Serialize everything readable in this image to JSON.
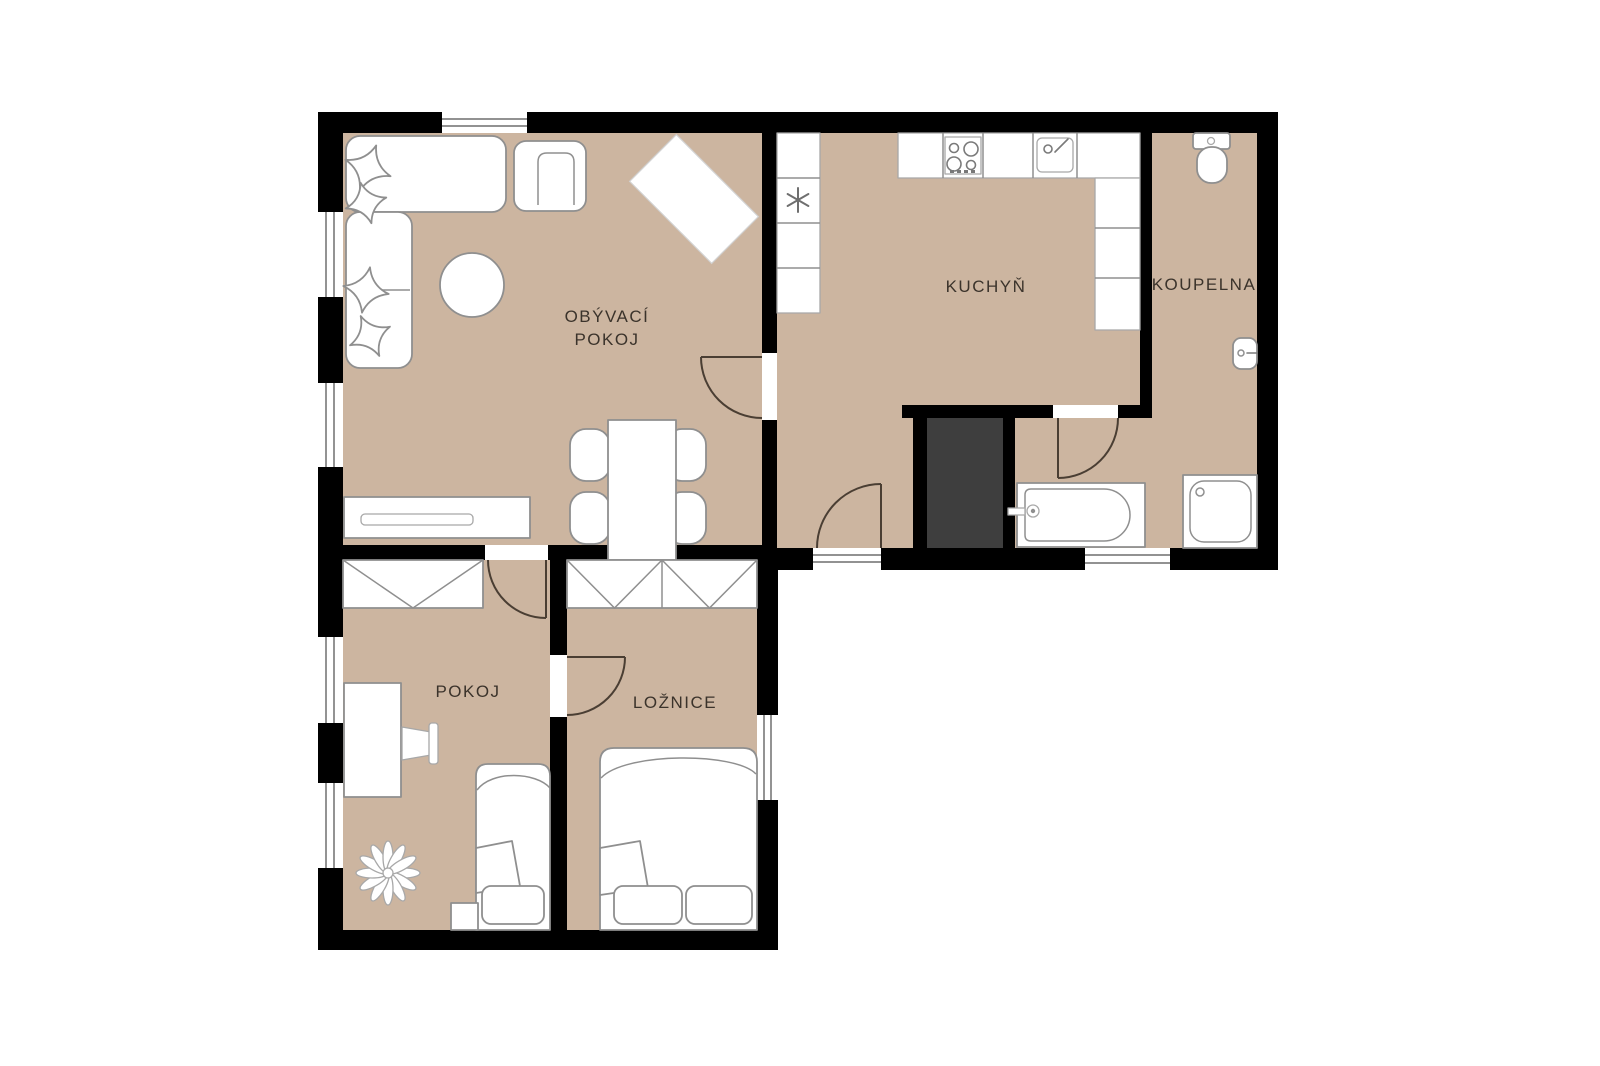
{
  "floorplan": {
    "title": "apartment-floor-plan",
    "rooms": {
      "living_room": {
        "label_line1": "OBÝVACÍ",
        "label_line2": "POKOJ"
      },
      "kitchen": {
        "label": "KUCHYŇ"
      },
      "bathroom": {
        "label": "KOUPELNA"
      },
      "room": {
        "label": "POKOJ"
      },
      "bedroom": {
        "label": "LOŽNICE"
      }
    },
    "colors": {
      "background": "#ffffff",
      "floor": "#ccb5a0",
      "wall": "#000000",
      "shaft": "#3e3e3e",
      "furniture_stroke": "#8f8f8f",
      "door_stroke": "#4a3e33",
      "label": "#3b332b"
    },
    "icons": [
      "sofa",
      "pillow",
      "coffee-table",
      "armchair",
      "tv-bench",
      "dining-table",
      "dining-chair",
      "sideboard",
      "fridge-snowflake",
      "stove",
      "kitchen-sink",
      "counter",
      "shaft",
      "bathtub",
      "shower",
      "toilet",
      "washbasin",
      "wardrobe",
      "desk",
      "desk-chair",
      "single-bed",
      "double-bed",
      "nightstand",
      "plant",
      "door-swing",
      "window"
    ]
  }
}
